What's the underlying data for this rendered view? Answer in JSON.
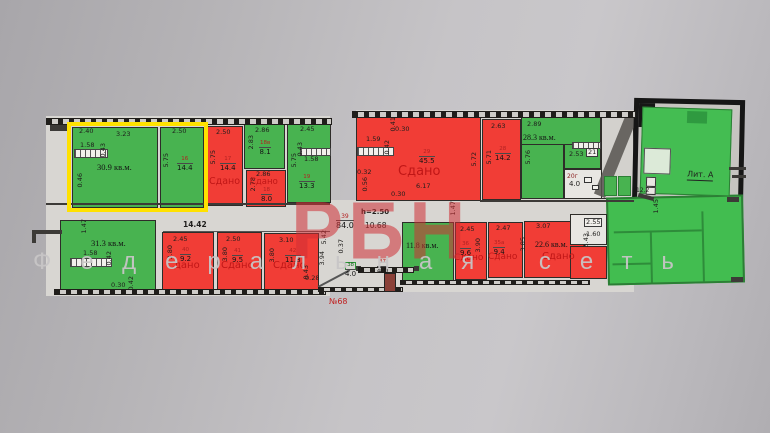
{
  "watermark": {
    "brand": "РБН",
    "tagline": "Федеральная сеть"
  },
  "plan_number": "№68",
  "status_rented": "Сдано",
  "colors": {
    "free_green": "#48b350",
    "rented_red": "#f13d36",
    "highlight_yellow": "#ffe100"
  },
  "rooms": {
    "r309": {
      "area": "30.9 кв.м.",
      "dim_top1": "2.40",
      "dim_top2": "3.23",
      "dim_w1": "1.58",
      "dim_w2": "0.43",
      "dim_w3": "0.46"
    },
    "r16": {
      "num": "16",
      "area": "14.4",
      "dim_top": "2.50",
      "dim_side": "5.75"
    },
    "r17": {
      "num": "17",
      "area": "14.4",
      "dim_top": "2.50",
      "dim_side": "5.75"
    },
    "r18v": {
      "num": "18в",
      "area": "8.1",
      "dim_top": "2.86",
      "dim_side": "2.83"
    },
    "r18": {
      "num": "18",
      "area": "8.0",
      "dim_top": "2.86",
      "dim_side": "2.78"
    },
    "r19": {
      "num": "19",
      "area": "13.3",
      "dim_top": "2.45",
      "dim_side": "5.75",
      "dim_w1": "0.43",
      "dim_w2": "1.58"
    },
    "r29": {
      "num": "29",
      "area": "45.5",
      "dim_side": "5.72",
      "d1": "0.41",
      "d2": "0.30",
      "d3": "1.59",
      "d4": "0.42",
      "d5": "0.32",
      "d6": "0.56",
      "d7": "0.30",
      "d8": "6.17"
    },
    "r28": {
      "num": "28",
      "area": "14.2",
      "dim_top": "2.63",
      "dim_side": "5.71"
    },
    "r283": {
      "area": "28.3 кв.м.",
      "dim_top": "2.89",
      "dim_side": "5.76"
    },
    "r21": {
      "num": "21",
      "dim": "2.53"
    },
    "r20g": {
      "num": "20г",
      "area": "4.0"
    },
    "r122": {
      "area": "12.2"
    },
    "lit_a": {
      "label": "Лит. А"
    },
    "corridor": {
      "num": "39",
      "area": "84.0",
      "ceiling": "h=2.50",
      "len": "10.68",
      "dim_left": "14.42",
      "dim_r": "1.47"
    },
    "r313": {
      "area": "31.3 кв.м.",
      "d1": "1.47",
      "d2": "1.58",
      "d3": "0.42",
      "d4": "0.30",
      "d5": "0.42"
    },
    "r40": {
      "num": "40",
      "area": "9.2",
      "dim_top": "2.45",
      "dim_side": "3.80"
    },
    "r41": {
      "num": "41",
      "area": "9.5",
      "dim_top": "2.50",
      "dim_side": "3.80"
    },
    "r42": {
      "num": "42",
      "area": "11.8",
      "dim_top": "3.10",
      "dim_side": "3.80"
    },
    "hall": {
      "d1": "5.42",
      "d2": "3.94",
      "d3": "0.37",
      "d4": "0.43",
      "d5": "0.28"
    },
    "r38": {
      "num": "38",
      "area": "4.0"
    },
    "r37": {
      "num": "37",
      "area": "4.0"
    },
    "r118": {
      "area": "11.8 кв.м."
    },
    "r36": {
      "num": "36",
      "area": "9.6",
      "dim_top": "2.45",
      "dim_side": "3.90"
    },
    "r35a": {
      "num": "35а",
      "area": "9.4",
      "dim_top": "2.47",
      "dim_side": "3.85"
    },
    "r226": {
      "area": "22.6 кв.м.",
      "dim_top": "3.07",
      "dim_side": "3.43"
    },
    "aux": {
      "d1": "2.55",
      "d2": "1.60"
    },
    "big_green": {
      "dim": "1.45"
    }
  }
}
